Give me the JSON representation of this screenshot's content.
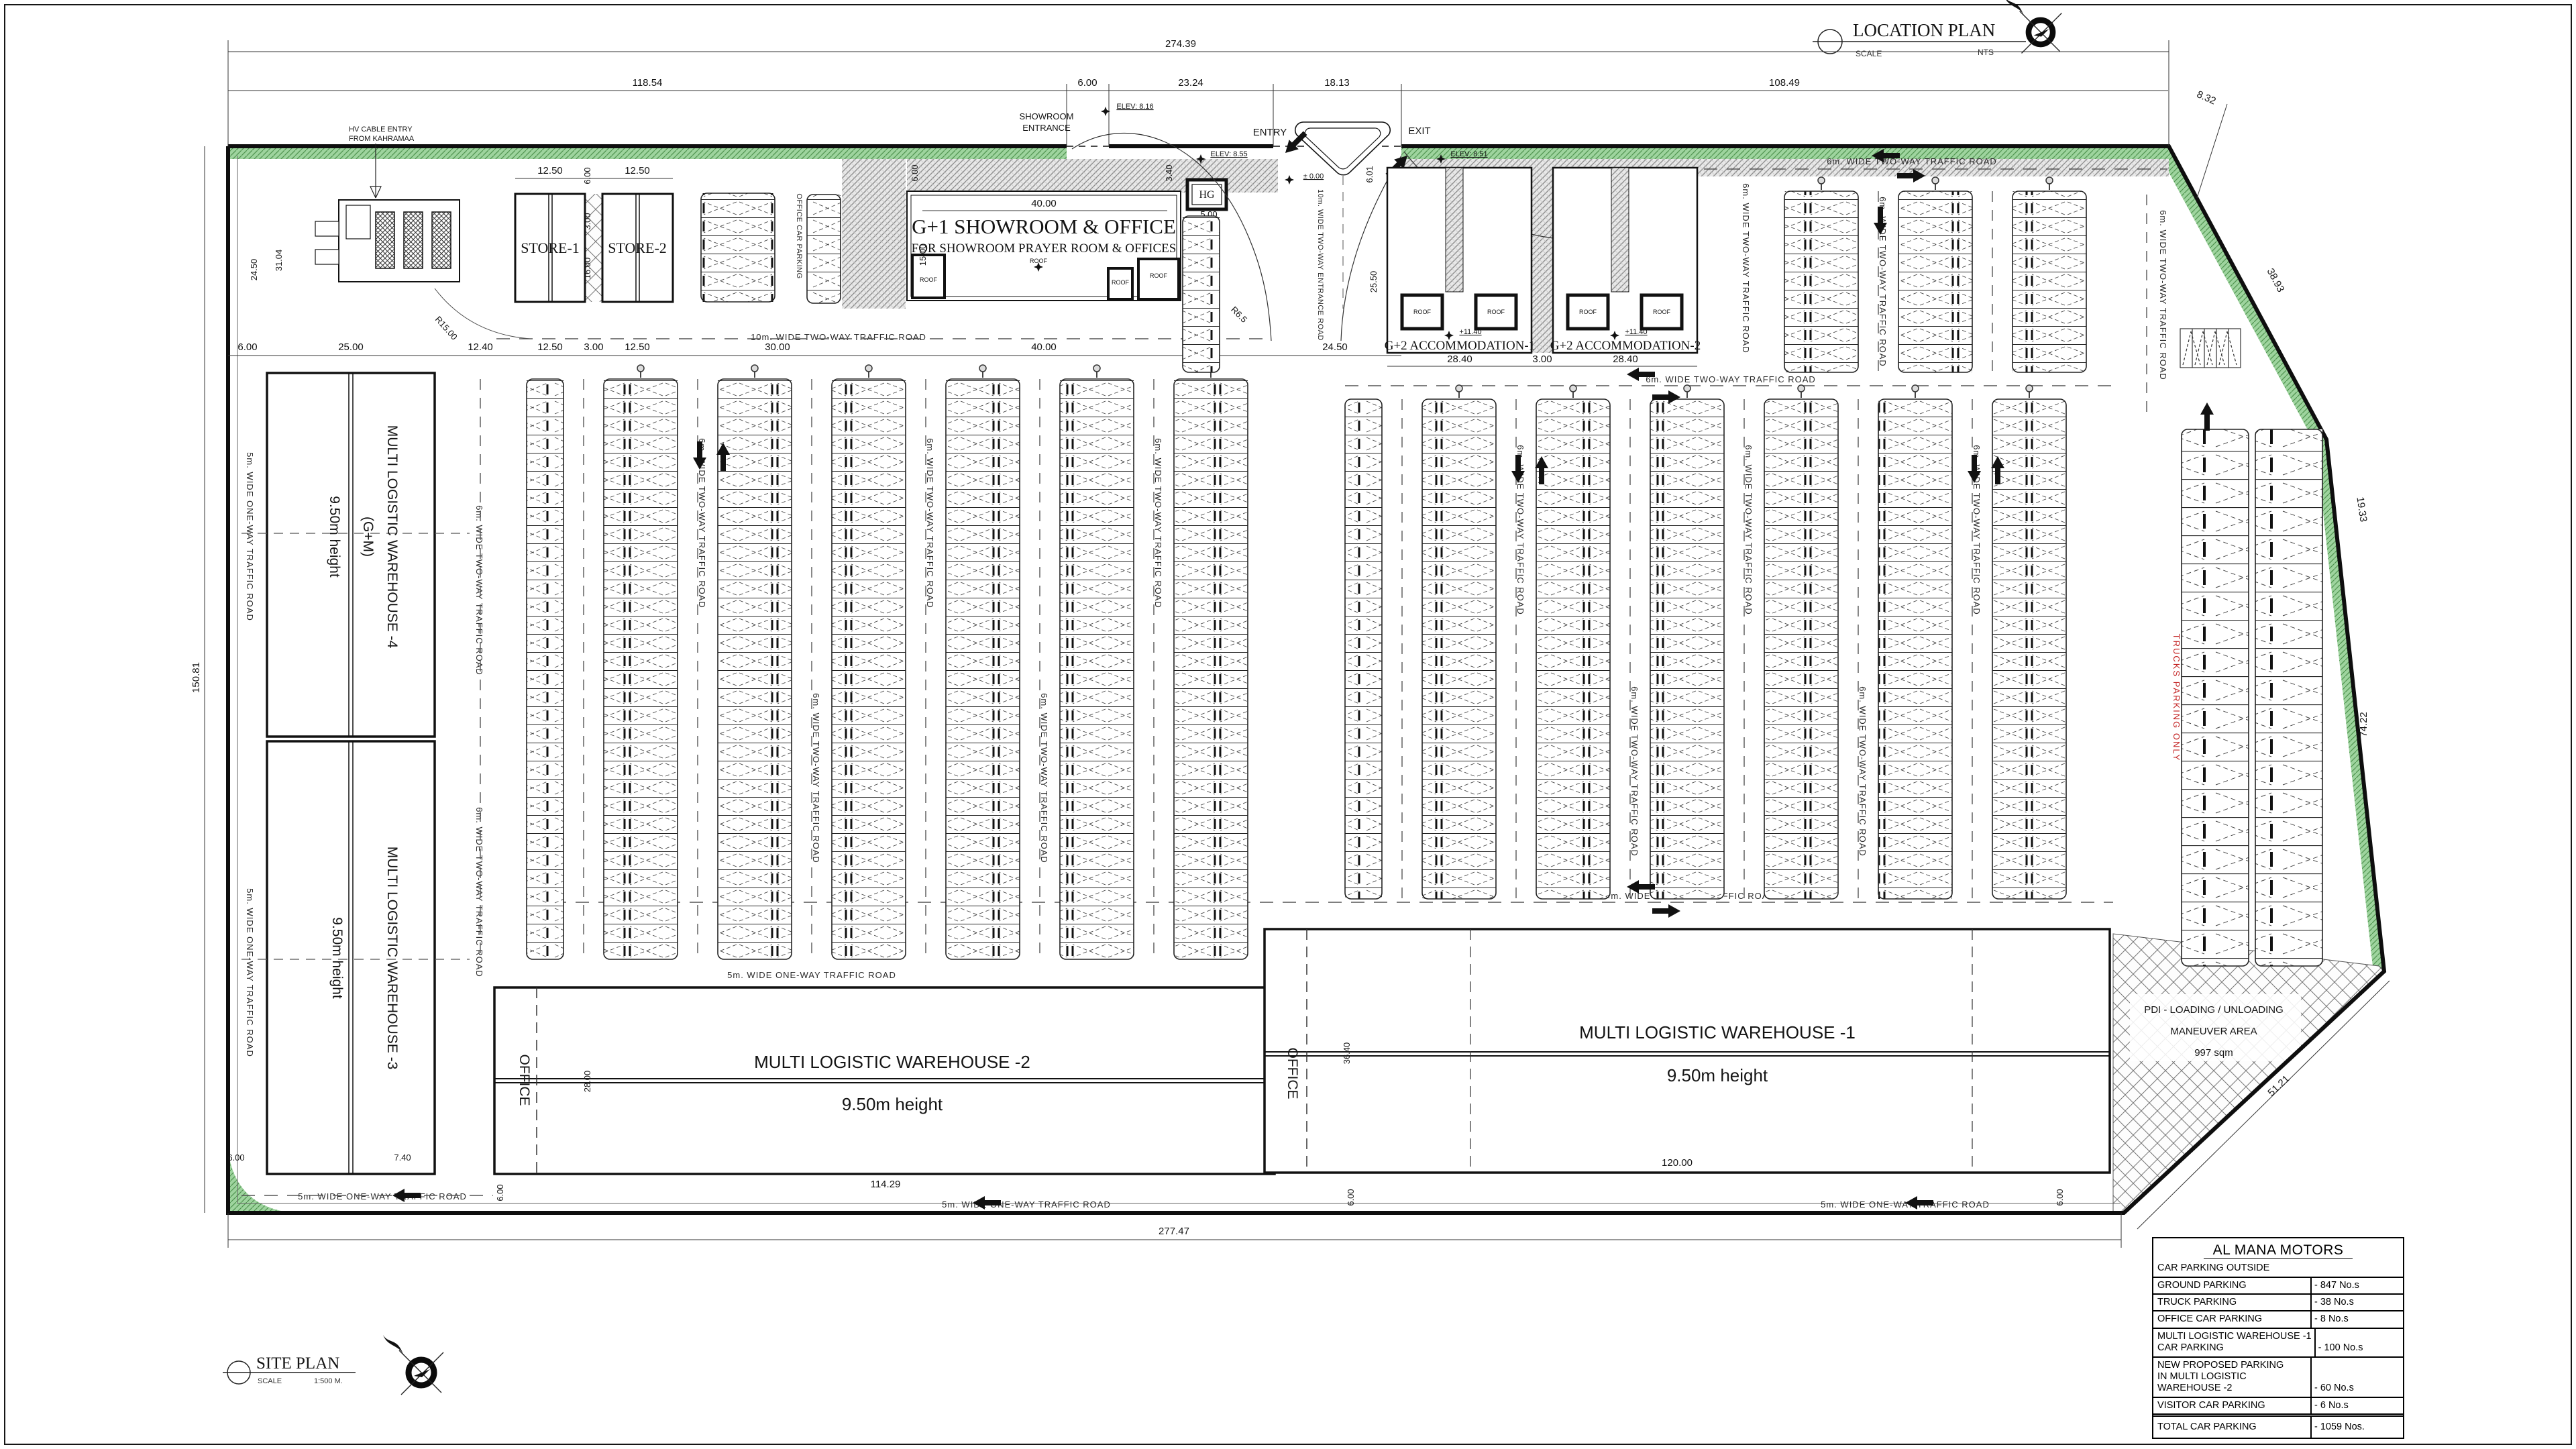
{
  "colors": {
    "line": "#151515",
    "green": "#8cc88c",
    "green_dark": "#3f7d3f",
    "hatch_gray": "#8f8f8f",
    "red_text": "#c32222",
    "white": "#ffffff"
  },
  "title_blocks": {
    "location": {
      "title": "LOCATION PLAN",
      "scale_label": "SCALE",
      "scale_value": "NTS"
    },
    "site": {
      "title": "SITE PLAN",
      "scale_label": "SCALE",
      "scale_value": "1:500 M."
    }
  },
  "parking_table": {
    "title": "AL MANA MOTORS",
    "section_header": "CAR PARKING OUTSIDE",
    "rows": [
      {
        "l1": "GROUND  PARKING",
        "v": "-  847 No.s"
      },
      {
        "l1": "TRUCK  PARKING",
        "v": "-  38 No.s"
      },
      {
        "l1": "OFFICE CAR PARKING",
        "v": "-  8 No.s"
      },
      {
        "l1": "MULTI LOGISTIC WAREHOUSE -1",
        "l2": "CAR PARKING",
        "v": "-  100 No.s"
      },
      {
        "l1": "NEW PROPOSED PARKING",
        "l2": "IN MULTI LOGISTIC",
        "l3": "WAREHOUSE -2",
        "v": "-  60 No.s"
      },
      {
        "l1": "VISITOR CAR PARKING",
        "v": "-  6 No.s"
      },
      {
        "l1": "TOTAL CAR PARKING",
        "v": "-  1059 Nos."
      }
    ]
  },
  "buildings": {
    "warehouse4": {
      "name": "MULTI LOGISTIC WAREHOUSE -4",
      "floors": "(G+M)",
      "height": "9.50m height"
    },
    "warehouse3": {
      "name": "MULTI LOGISTIC WAREHOUSE -3",
      "height": "9.50m height"
    },
    "warehouse2": {
      "name": "MULTI LOGISTIC WAREHOUSE -2",
      "height": "9.50m height"
    },
    "warehouse1": {
      "name": "MULTI LOGISTIC WAREHOUSE -1",
      "height": "9.50m height"
    },
    "showroom": {
      "name": "G+1 SHOWROOM & OFFICE",
      "subtitle": "FOR SHOWROOM    PRAYER ROOM & OFFICES"
    },
    "store1": "STORE-1",
    "store2": "STORE-2",
    "acc1": "G+2 ACCOMMODATION-1",
    "acc2": "G+2 ACCOMMODATION-2",
    "office": "OFFICE",
    "roof": "ROOF",
    "roof_level": "+11.40",
    "hg": "HG"
  },
  "roads": {
    "one_way_5m": "5m. WIDE ONE-WAY TRAFFIC ROAD",
    "two_way_6m": "6m. WIDE TWO-WAY TRAFFIC ROAD",
    "two_way_10m": "10m. WIDE TWO-WAY TRAFFIC ROAD",
    "entrance_10m": "10m. WIDE TWO-WAY ENTRANCE ROAD"
  },
  "labels": {
    "showroom_entrance_1": "SHOWROOM",
    "showroom_entrance_2": "ENTRANCE",
    "entry": "ENTRY",
    "exit": "EXIT",
    "zero_level": "± 0.00",
    "elev1": "ELEV: 8.16",
    "elev2": "ELEV: 8.55",
    "elev3": "ELEV: 8.51",
    "hv_cable_1": "HV CABLE ENTRY",
    "hv_cable_2": "FROM KAHRAMAA",
    "trucks_only": "TRUCKS PARKING ONLY",
    "pdi_1": "PDI - LOADING / UNLOADING",
    "pdi_2": "MANEUVER AREA",
    "pdi_3": "997 sqm",
    "visitor_parking": "VISITOR CAR PARKING",
    "office_parking": "OFFICE CAR PARKING"
  },
  "dims": {
    "v274_39": "274.39",
    "v118_54": "118.54",
    "v6_00": "6.00",
    "v23_24": "23.24",
    "v18_13": "18.13",
    "v108_49": "108.49",
    "v8_32": "8.32",
    "v150_81": "150.81",
    "v277_47": "277.47",
    "v12_50": "12.50",
    "v3_00": "3.00",
    "v16_00": "16.00",
    "v25_00": "25.00",
    "v12_40": "12.40",
    "v30_00": "30.00",
    "v40_00": "40.00",
    "v24_50": "24.50",
    "v31_04": "31.04",
    "v15_00": "15.00",
    "v5_00": "5.00",
    "v3_40": "3.40",
    "v28_40": "28.40",
    "v25_50": "25.50",
    "v6_01": "6.01",
    "v28_00": "28.00",
    "v36_40": "36.40",
    "v114_29": "114.29",
    "v120_00": "120.00",
    "v7_40": "7.40",
    "v74_22": "74.22",
    "v38_93": "38.93",
    "v19_33": "19.33",
    "v51_21": "51.21",
    "v36_06": "36.06",
    "r15": "R15.00",
    "r6_5": "R6.5"
  }
}
